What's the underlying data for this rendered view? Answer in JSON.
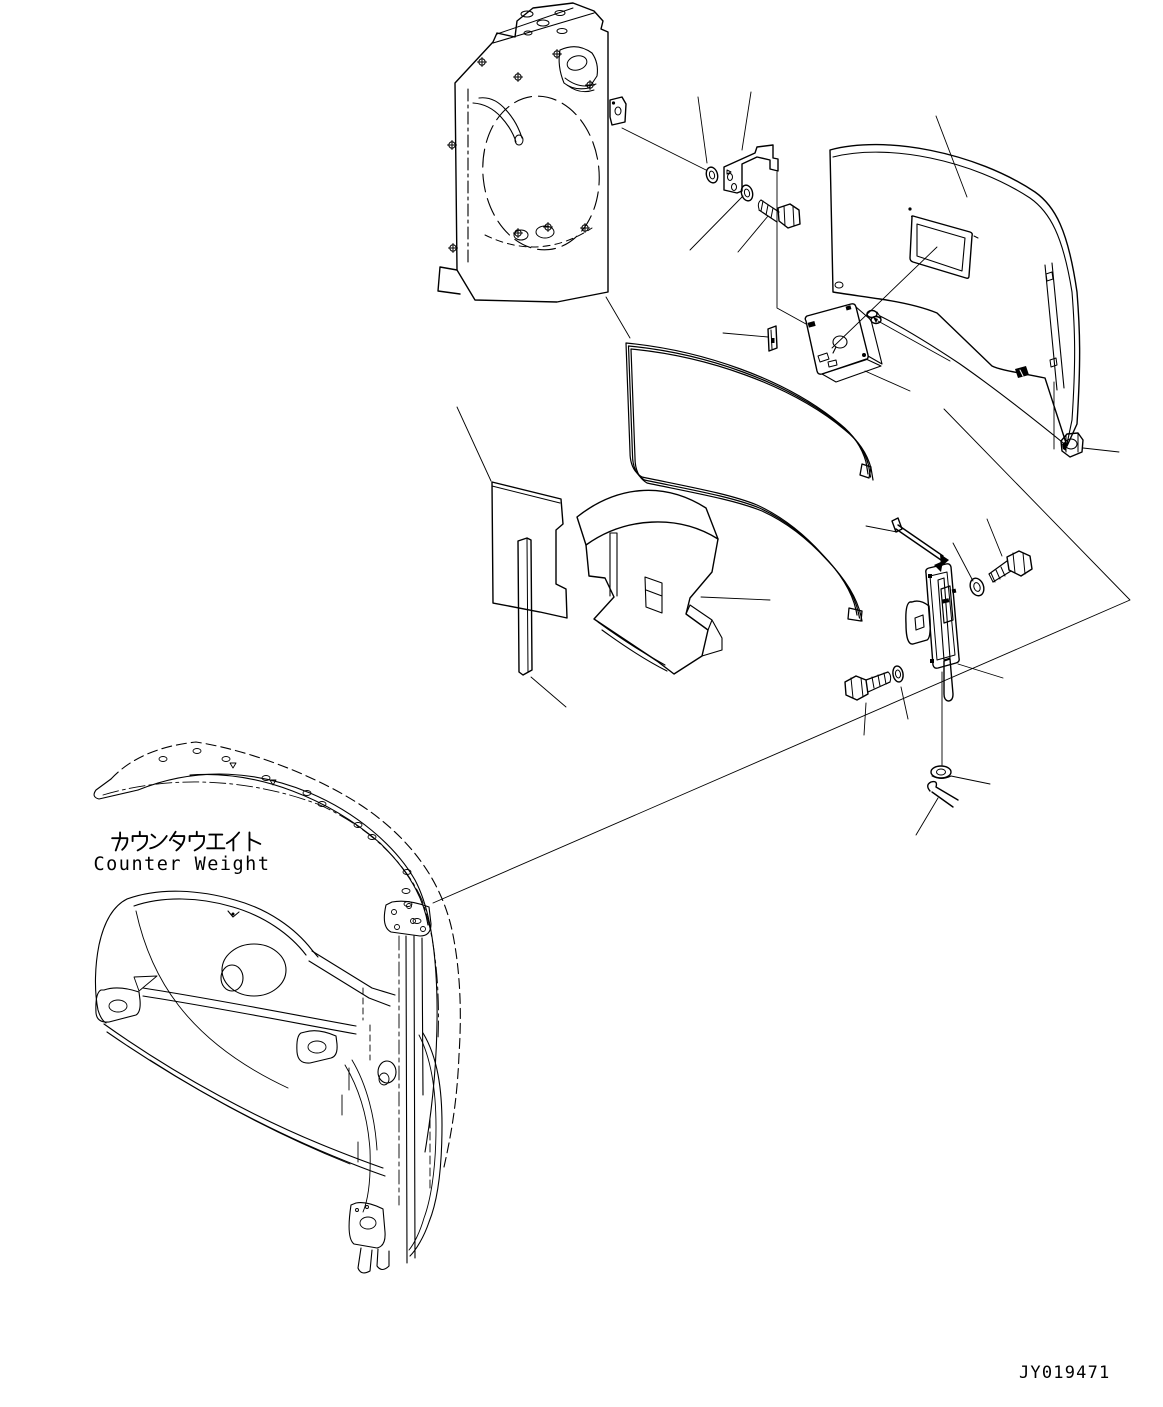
{
  "diagram": {
    "type": "exploded parts diagram",
    "title_jp": "カウンタウエイト",
    "title_en": "Counter Weight",
    "drawing_number": "JY019471",
    "colors": {
      "line": "#000000",
      "background": "#ffffff"
    }
  }
}
